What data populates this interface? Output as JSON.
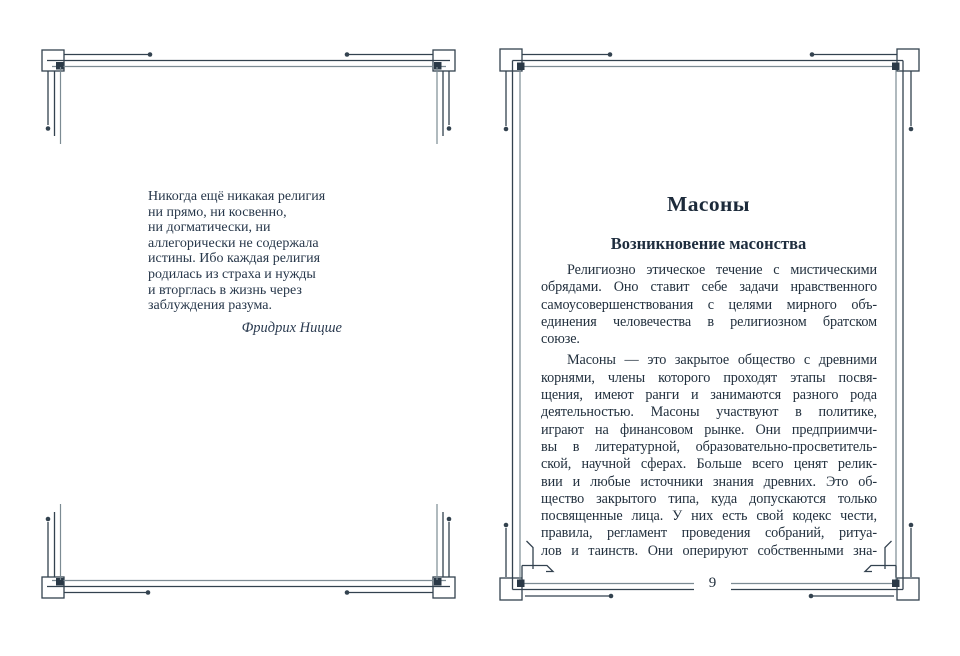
{
  "left_page": {
    "quote_lines": [
      "Никогда ещё никакая религия",
      "ни прямо, ни косвенно,",
      "ни догматически, ни",
      "аллегорически не содержала",
      "истины. Ибо каждая религия",
      "родилась из страха и нужды",
      "и вторглась в жизнь через",
      "заблуждения разума."
    ],
    "attribution": "Фридрих Ницше"
  },
  "right_page": {
    "title": "Масоны",
    "subtitle": "Возникновение масонства",
    "paragraphs": [
      {
        "first_line_indent": true,
        "last_line_left": true,
        "lines": [
          "Религиозно этическое течение с мистическими",
          "обрядами. Оно ставит себе задачи нравственного",
          "самоусовершенствования с целями мирного объ-",
          "единения человечества в религиозном братском",
          "союзе."
        ]
      },
      {
        "first_line_indent": true,
        "last_line_left": false,
        "lines": [
          "Масоны — это закрытое общество с древними",
          "корнями, члены которого проходят этапы посвя-",
          "щения, имеют ранги и занимаются разного рода",
          "деятельностью. Масоны участвуют в политике,",
          "играют на финансовом рынке. Они предприимчи-",
          "вы в литературной, образовательно-просветитель-",
          "ской, научной сферах. Больше всего ценят релик-",
          "вии и любые источники знания древних. Это об-",
          "щество закрытого типа, куда допускаются только",
          "посвященные лица. У них есть свой кодекс чести,",
          "правила, регламент проведения собраний, ритуа-",
          "лов и таинств. Они оперируют собственными зна-"
        ]
      }
    ],
    "page_number": "9"
  },
  "colors": {
    "paper": "#ffffff",
    "ink": "#22303e",
    "frame_dark": "#33424f",
    "frame_gray": "#7c8b93"
  }
}
